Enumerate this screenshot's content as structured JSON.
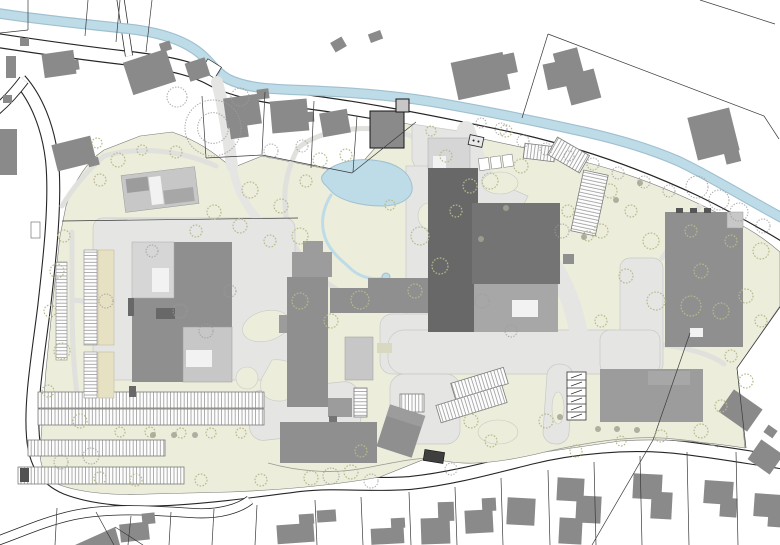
{
  "map": {
    "kind": "architectural-site-plan",
    "features_legend": [
      "stream",
      "pond",
      "creek",
      "campus-green",
      "plaza",
      "footpath",
      "building",
      "parking-row",
      "garage-stalls",
      "tree",
      "bush",
      "road",
      "parcel-line",
      "off-site-house",
      "bridge",
      "bus-shelter",
      "transformer-box"
    ]
  },
  "colors": {
    "page_bg": "#ffffff",
    "line_dark": "#262626",
    "water": "#bedbe8",
    "water_edge": "#9fc0d0",
    "site_green": "#ecedda",
    "plaza": "#e5e5e3",
    "plaza_edge": "#c9c9c7",
    "bld_dark": "#686868",
    "bld_dk2": "#747474",
    "bld_med": "#8f8f8f",
    "bld_med2": "#9c9c9c",
    "bld_grey": "#a7a7a7",
    "bld_light": "#c7c7c7",
    "bld_lighter": "#d6d6d6",
    "house": "#8a8a8a",
    "strip_beige": "#e7e1c3",
    "parcel": "#3a3a3a",
    "tree_olive": "#b9b98d",
    "tree_gray": "#9c9c9c",
    "bush": "#a3a393"
  },
  "features": {
    "parking_rows": [
      [
        38,
        392,
        226,
        16,
        0,
        "v"
      ],
      [
        38,
        409,
        226,
        16,
        0,
        "v"
      ],
      [
        28,
        440,
        137,
        16,
        0,
        "v"
      ],
      [
        18,
        467,
        166,
        17,
        0,
        "v"
      ],
      [
        400,
        394,
        24,
        18,
        0,
        "v"
      ],
      [
        452,
        375,
        55,
        17,
        -17,
        "v"
      ],
      [
        437,
        395,
        69,
        18,
        -17,
        "v"
      ],
      [
        524,
        145,
        31,
        15,
        7,
        "v"
      ],
      [
        550,
        145,
        37,
        20,
        30,
        "v"
      ],
      [
        577,
        172,
        25,
        62,
        12,
        "h"
      ],
      [
        354,
        388,
        13,
        29,
        0,
        "h"
      ]
    ],
    "garage_stalls": {
      "x": 567,
      "y": 372,
      "w": 19,
      "cell": 8,
      "count": 6
    },
    "houses": [
      [
        6,
        56,
        10,
        22,
        0
      ],
      [
        20,
        38,
        9,
        8,
        0
      ],
      [
        43,
        52,
        32,
        24,
        -8
      ],
      [
        70,
        60,
        9,
        10,
        -8
      ],
      [
        0,
        129,
        17,
        46,
        0
      ],
      [
        3,
        95,
        9,
        8,
        0
      ],
      [
        54,
        140,
        40,
        27,
        -14
      ],
      [
        88,
        158,
        11,
        8,
        -14
      ],
      [
        127,
        55,
        45,
        34,
        -18
      ],
      [
        160,
        42,
        11,
        9,
        -18
      ],
      [
        187,
        60,
        21,
        19,
        -18
      ],
      [
        225,
        96,
        35,
        30,
        -8
      ],
      [
        230,
        125,
        18,
        13,
        -8
      ],
      [
        257,
        89,
        12,
        10,
        -8
      ],
      [
        271,
        100,
        37,
        32,
        -5
      ],
      [
        302,
        112,
        12,
        10,
        -5
      ],
      [
        321,
        111,
        28,
        24,
        -10
      ],
      [
        332,
        39,
        13,
        11,
        -30
      ],
      [
        369,
        32,
        13,
        9,
        -20
      ],
      [
        454,
        57,
        53,
        38,
        -12
      ],
      [
        499,
        54,
        17,
        20,
        -12
      ],
      [
        545,
        62,
        23,
        26,
        -12
      ],
      [
        556,
        50,
        25,
        28,
        -15
      ],
      [
        567,
        72,
        31,
        30,
        -15
      ],
      [
        692,
        112,
        43,
        44,
        -14
      ],
      [
        725,
        151,
        15,
        12,
        -14
      ],
      [
        723,
        397,
        35,
        27,
        35
      ],
      [
        752,
        445,
        27,
        24,
        35
      ],
      [
        765,
        427,
        11,
        9,
        35
      ],
      [
        120,
        523,
        29,
        18,
        -6
      ],
      [
        142,
        513,
        13,
        11,
        -6
      ],
      [
        277,
        524,
        37,
        19,
        -4
      ],
      [
        299,
        514,
        15,
        10,
        -4
      ],
      [
        317,
        510,
        19,
        12,
        -4
      ],
      [
        371,
        528,
        33,
        16,
        -3
      ],
      [
        391,
        518,
        14,
        10,
        -3
      ],
      [
        421,
        518,
        29,
        26,
        -2
      ],
      [
        438,
        502,
        16,
        19,
        -2
      ],
      [
        465,
        510,
        28,
        23,
        -3
      ],
      [
        482,
        498,
        14,
        13,
        -3
      ],
      [
        507,
        498,
        28,
        27,
        3
      ],
      [
        557,
        478,
        27,
        23,
        3
      ],
      [
        576,
        496,
        25,
        27,
        3
      ],
      [
        559,
        518,
        23,
        26,
        3
      ],
      [
        633,
        474,
        29,
        25,
        3
      ],
      [
        651,
        492,
        21,
        27,
        3
      ],
      [
        704,
        481,
        29,
        23,
        4
      ],
      [
        720,
        498,
        17,
        19,
        4
      ],
      [
        754,
        494,
        27,
        23,
        4
      ],
      [
        768,
        510,
        15,
        17,
        4
      ]
    ],
    "parcel_lines": [
      [
        28,
        0,
        28,
        30
      ],
      [
        28,
        30,
        0,
        33
      ],
      [
        88,
        0,
        85,
        36
      ],
      [
        120,
        0,
        116,
        42
      ],
      [
        152,
        0,
        146,
        52
      ],
      [
        202,
        96,
        206,
        158
      ],
      [
        206,
        158,
        262,
        155
      ],
      [
        262,
        155,
        352,
        173
      ],
      [
        352,
        173,
        416,
        122
      ],
      [
        265,
        92,
        262,
        154
      ],
      [
        314,
        101,
        311,
        168
      ],
      [
        357,
        116,
        353,
        172
      ],
      [
        548,
        34,
        764,
        116
      ],
      [
        548,
        34,
        522,
        118
      ],
      [
        700,
        0,
        775,
        24
      ],
      [
        764,
        116,
        779,
        139
      ],
      [
        780,
        307,
        737,
        368
      ],
      [
        737,
        368,
        746,
        448
      ],
      [
        690,
        333,
        653,
        440
      ],
      [
        653,
        440,
        592,
        545
      ],
      [
        62,
        221,
        298,
        218
      ],
      [
        131,
        516,
        128,
        545
      ],
      [
        171,
        512,
        169,
        545
      ],
      [
        214,
        509,
        212,
        545
      ],
      [
        257,
        505,
        255,
        545
      ],
      [
        315,
        500,
        317,
        545
      ],
      [
        361,
        497,
        363,
        545
      ],
      [
        409,
        492,
        411,
        545
      ],
      [
        455,
        487,
        457,
        545
      ],
      [
        501,
        478,
        503,
        545
      ],
      [
        548,
        470,
        550,
        545
      ],
      [
        594,
        462,
        596,
        545
      ],
      [
        640,
        456,
        642,
        545
      ],
      [
        687,
        452,
        689,
        545
      ],
      [
        736,
        452,
        738,
        545
      ],
      [
        57,
        508,
        55,
        545
      ],
      [
        96,
        512,
        114,
        545
      ],
      [
        115,
        527,
        143,
        545
      ]
    ],
    "trees_olive": [
      [
        118,
        160,
        7
      ],
      [
        100,
        180,
        6
      ],
      [
        142,
        150,
        5
      ],
      [
        176,
        152,
        6
      ],
      [
        97,
        143,
        5
      ],
      [
        250,
        190,
        8
      ],
      [
        281,
        206,
        7
      ],
      [
        300,
        236,
        8
      ],
      [
        270,
        241,
        6
      ],
      [
        240,
        226,
        7
      ],
      [
        214,
        212,
        7
      ],
      [
        196,
        231,
        6
      ],
      [
        320,
        160,
        7
      ],
      [
        346,
        155,
        6
      ],
      [
        306,
        181,
        6
      ],
      [
        390,
        205,
        5
      ],
      [
        420,
        236,
        9
      ],
      [
        440,
        266,
        8
      ],
      [
        415,
        291,
        7
      ],
      [
        300,
        301,
        8
      ],
      [
        331,
        321,
        7
      ],
      [
        360,
        300,
        9
      ],
      [
        64,
        236,
        6
      ],
      [
        57,
        271,
        7
      ],
      [
        50,
        311,
        6
      ],
      [
        62,
        351,
        8
      ],
      [
        48,
        391,
        6
      ],
      [
        80,
        421,
        7
      ],
      [
        120,
        432,
        5
      ],
      [
        150,
        432,
        5
      ],
      [
        181,
        433,
        5
      ],
      [
        211,
        433,
        5
      ],
      [
        241,
        433,
        5
      ],
      [
        100,
        478,
        6
      ],
      [
        136,
        480,
        6
      ],
      [
        201,
        480,
        6
      ],
      [
        261,
        480,
        6
      ],
      [
        311,
        478,
        7
      ],
      [
        351,
        472,
        7
      ],
      [
        431,
        131,
        5
      ],
      [
        446,
        156,
        6
      ],
      [
        470,
        186,
        7
      ],
      [
        456,
        211,
        6
      ],
      [
        490,
        181,
        8
      ],
      [
        521,
        166,
        7
      ],
      [
        506,
        131,
        6
      ],
      [
        610,
        191,
        7
      ],
      [
        631,
        211,
        6
      ],
      [
        601,
        231,
        7
      ],
      [
        651,
        241,
        8
      ],
      [
        626,
        276,
        7
      ],
      [
        656,
        301,
        9
      ],
      [
        691,
        306,
        10
      ],
      [
        721,
        311,
        8
      ],
      [
        746,
        296,
        7
      ],
      [
        761,
        321,
        6
      ],
      [
        701,
        271,
        7
      ],
      [
        731,
        241,
        6
      ],
      [
        761,
        251,
        8
      ],
      [
        691,
        231,
        6
      ],
      [
        601,
        321,
        6
      ],
      [
        546,
        421,
        7
      ],
      [
        576,
        451,
        6
      ],
      [
        621,
        441,
        5
      ],
      [
        661,
        436,
        6
      ],
      [
        701,
        431,
        7
      ],
      [
        721,
        406,
        6
      ],
      [
        746,
        381,
        7
      ],
      [
        731,
        356,
        6
      ],
      [
        471,
        421,
        7
      ],
      [
        491,
        441,
        6
      ],
      [
        361,
        451,
        6
      ],
      [
        568,
        211,
        6
      ],
      [
        588,
        236,
        5
      ]
    ],
    "trees_gray": [
      [
        213,
        128,
        28
      ],
      [
        240,
        97,
        9
      ],
      [
        177,
        97,
        10
      ],
      [
        481,
        123,
        5
      ],
      [
        501,
        129,
        6
      ],
      [
        523,
        141,
        6
      ],
      [
        546,
        149,
        6
      ],
      [
        569,
        156,
        5
      ],
      [
        593,
        164,
        6
      ],
      [
        618,
        173,
        6
      ],
      [
        644,
        182,
        6
      ],
      [
        669,
        191,
        6
      ],
      [
        697,
        187,
        11
      ],
      [
        719,
        200,
        10
      ],
      [
        739,
        212,
        9
      ],
      [
        302,
        146,
        6
      ],
      [
        271,
        151,
        7
      ],
      [
        763,
        226,
        7
      ],
      [
        180,
        311,
        7
      ],
      [
        106,
        301,
        7
      ],
      [
        230,
        291,
        6
      ],
      [
        206,
        331,
        7
      ],
      [
        152,
        251,
        6
      ],
      [
        91,
        456,
        8
      ],
      [
        61,
        462,
        7
      ],
      [
        331,
        476,
        8
      ],
      [
        371,
        481,
        7
      ],
      [
        451,
        469,
        6
      ],
      [
        511,
        331,
        6
      ],
      [
        482,
        301,
        7
      ],
      [
        562,
        231,
        7
      ]
    ],
    "bushes": [
      [
        153,
        435
      ],
      [
        174,
        435
      ],
      [
        195,
        435
      ],
      [
        598,
        429
      ],
      [
        617,
        429
      ],
      [
        637,
        430
      ],
      [
        640,
        183
      ],
      [
        616,
        200
      ],
      [
        584,
        237
      ],
      [
        506,
        208
      ],
      [
        481,
        239
      ],
      [
        560,
        417
      ]
    ]
  }
}
